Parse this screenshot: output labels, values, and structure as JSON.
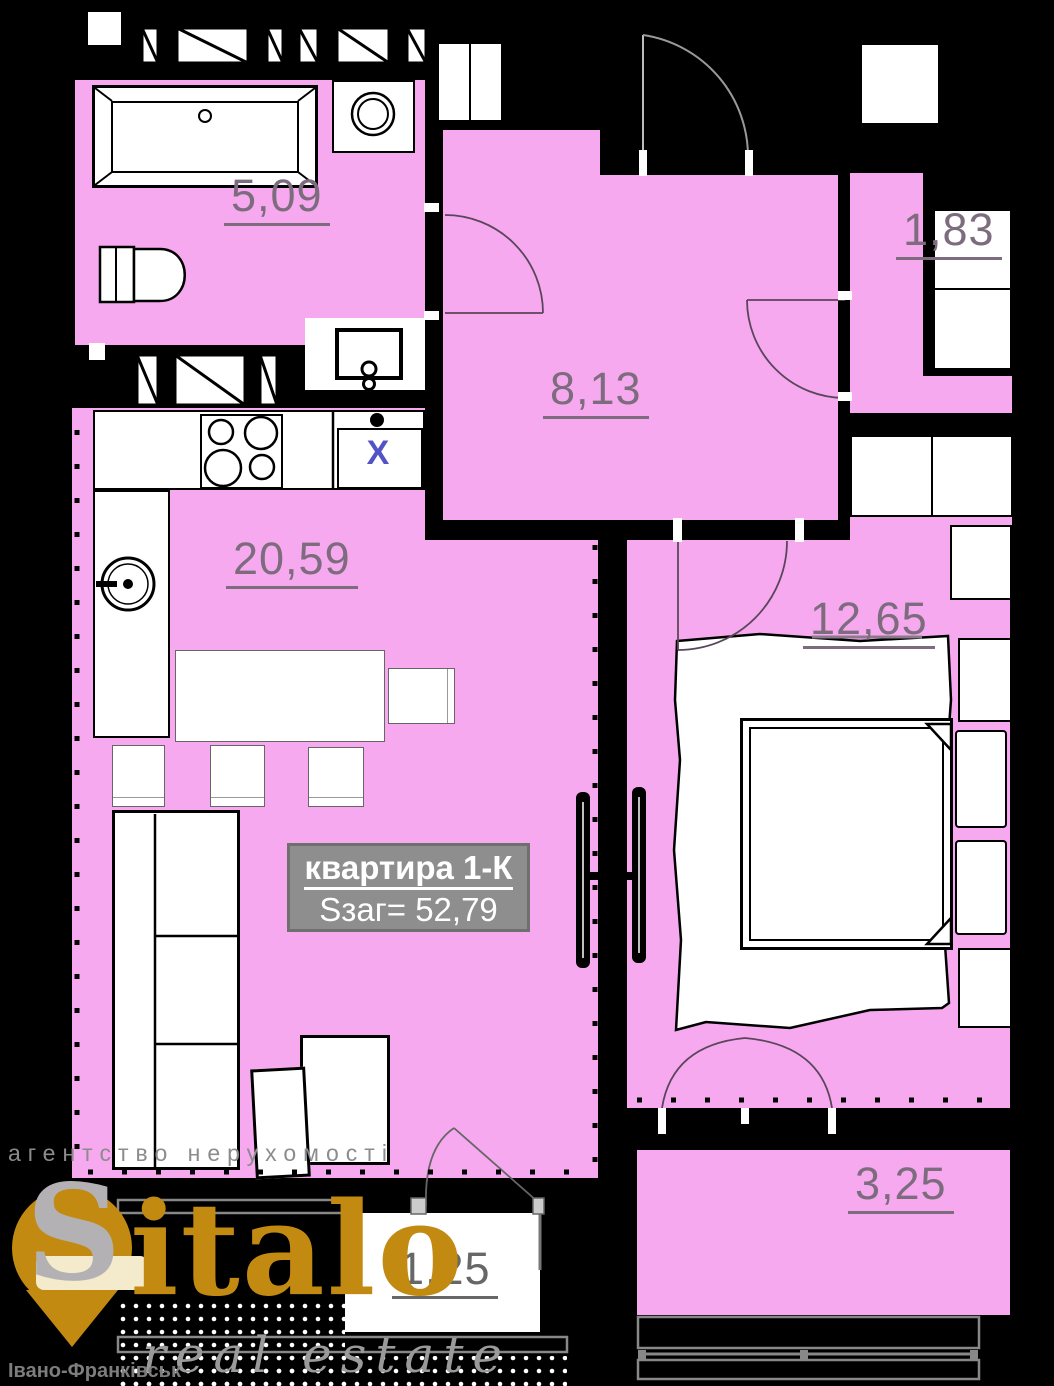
{
  "colors": {
    "room_pink": "#f7a9f0",
    "area_text": "#7d6c7d",
    "label_box_bg": "#8e8e8e",
    "label_box_border": "#6f6f6f",
    "gold": "#c28a10",
    "watermark_gray": "#999999",
    "sink_x_blue": "#5353c8"
  },
  "apartment_label": {
    "title": "квартира 1-К",
    "area_line": "Sзаг= 52,79"
  },
  "rooms": {
    "bathroom": {
      "area": "5,09"
    },
    "hallway": {
      "area": "8,13"
    },
    "closet": {
      "area": "1,83"
    },
    "kitchen_living": {
      "area": "20,59"
    },
    "bedroom": {
      "area": "12,65"
    },
    "balcony_small": {
      "area": "1,25"
    },
    "balcony_large": {
      "area": "3,25"
    }
  },
  "fixtures": {
    "kitchen_sink_mark": "X"
  },
  "watermark": {
    "agency": "агентство нерухомості",
    "brand_initial": "S",
    "brand": "italo",
    "tagline": "real estate",
    "city": "Івано-Франківськ"
  }
}
